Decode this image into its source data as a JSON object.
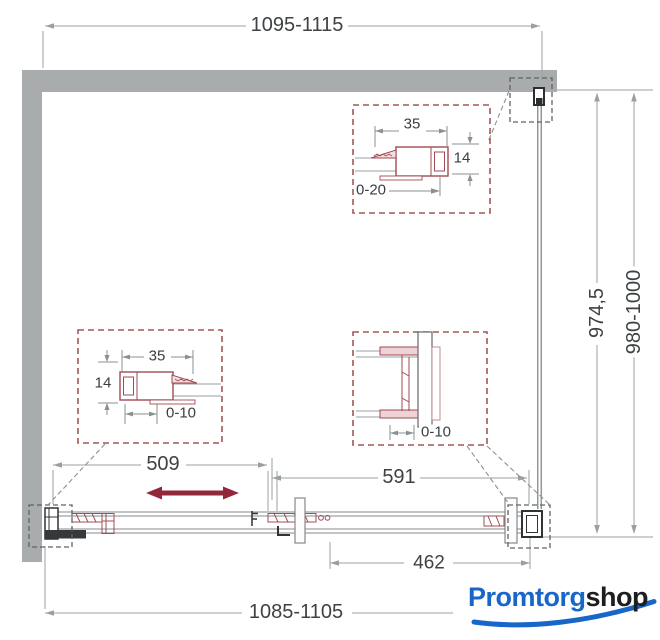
{
  "drawing": {
    "title": "sliding shower door dimension drawing",
    "dims": {
      "top_width": "1095-1115",
      "bottom_width": "1085-1105",
      "glass_height": "974,5",
      "total_height": "980-1000",
      "door_travel": "509",
      "fixed_panel_width": "591",
      "overlap_width": "462"
    },
    "details": {
      "top": {
        "width": "35",
        "height": "14",
        "range": "0-20"
      },
      "left": {
        "width": "35",
        "height": "14",
        "range": "0-10"
      },
      "right": {
        "range": "0-10"
      }
    },
    "colors": {
      "wall_gray": "#a8acac",
      "callout_red": "#a25757",
      "arrow_red": "#93283a",
      "logo_blue": "#1766c8"
    }
  },
  "logo": {
    "primary": "Promtorg",
    "secondary": "shop"
  }
}
